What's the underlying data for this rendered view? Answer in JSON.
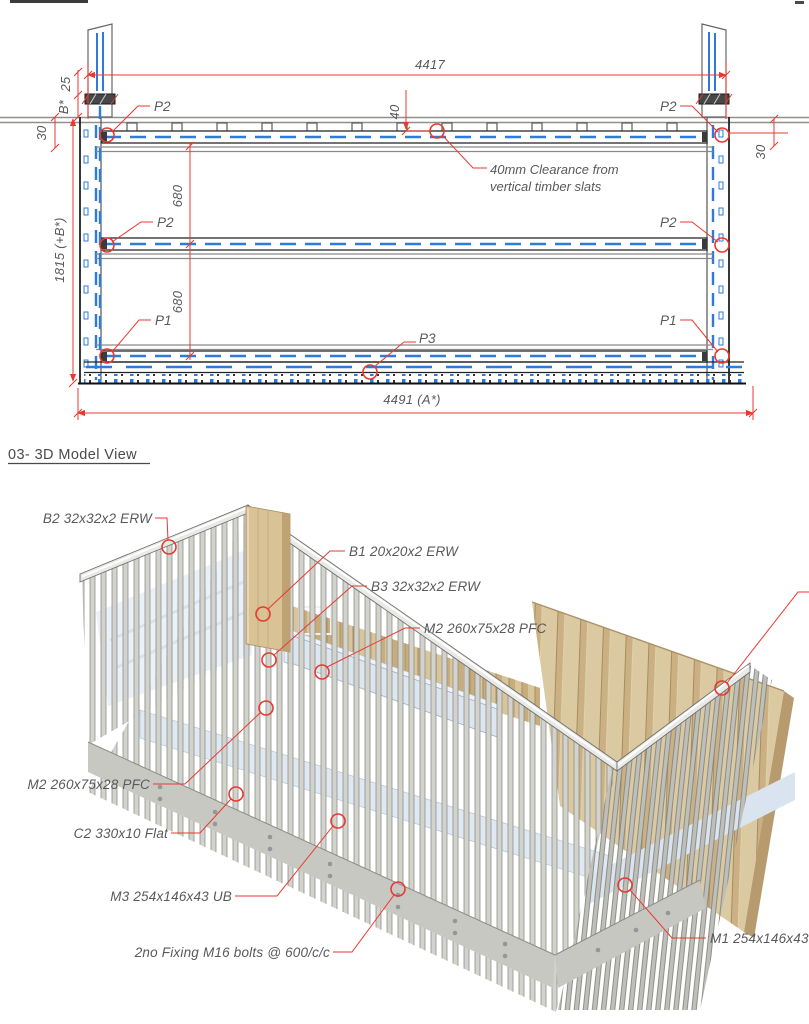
{
  "drawing2d": {
    "dim_top_width": "4417",
    "dim_bottom_width": "4491 (A*)",
    "dim_height": "1815 (+B*)",
    "dim_top_offset": "25",
    "dim_b_star": "B*",
    "dim_left_gap": "30",
    "dim_right_gap": "30",
    "dim_rail_gap_upper": "680",
    "dim_rail_gap_lower": "680",
    "dim_clearance": "40",
    "label_p1": "P1",
    "label_p2": "P2",
    "label_p3": "P3",
    "note_clearance_line1": "40mm Clearance from",
    "note_clearance_line2": "vertical timber slats"
  },
  "model3d": {
    "title": "03- 3D Model View",
    "annotations": [
      {
        "id": "b2",
        "label": "B2 32x32x2 ERW"
      },
      {
        "id": "b1",
        "label": "B1 20x20x2 ERW"
      },
      {
        "id": "b3",
        "label": "B3 32x32x2 ERW"
      },
      {
        "id": "m2_right",
        "label": "M2 260x75x28 PFC"
      },
      {
        "id": "m2_left",
        "label": "M2 260x75x28 PFC"
      },
      {
        "id": "c2",
        "label": "C2 330x10 Flat"
      },
      {
        "id": "m3",
        "label": "M3 254x146x43 UB"
      },
      {
        "id": "fixing",
        "label": "2no Fixing M16 bolts @ 600/c/c"
      },
      {
        "id": "m1",
        "label": "M1 254x146x43 UB"
      }
    ]
  },
  "colors": {
    "annotation_red": "#e8392f",
    "detail_blue": "#2e7bdc",
    "timber": "#d8c498",
    "steel_light": "#d2d2cd",
    "channel_blue": "#dce6f1",
    "text_gray": "#58595b"
  }
}
